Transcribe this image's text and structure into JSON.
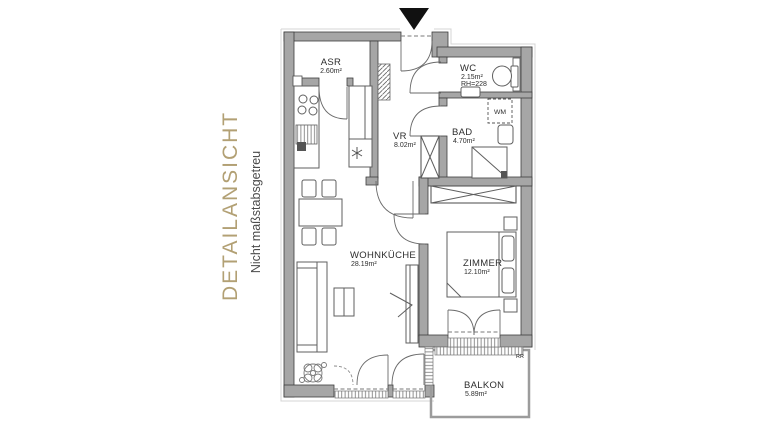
{
  "sidebar": {
    "title": "DETAILANSICHT",
    "subtitle": "Nicht maßstabsgetreu",
    "title_color": "#b2a074",
    "subtitle_color": "#4b4b4b"
  },
  "plan": {
    "rooms": [
      {
        "name": "ASR",
        "area": "2.60m²"
      },
      {
        "name": "WC",
        "area": "2.15m²",
        "note": "RH=228"
      },
      {
        "name": "BAD",
        "area": "4.70m²"
      },
      {
        "name": "VR",
        "area": "8.02m²"
      },
      {
        "name": "WOHNKÜCHE",
        "area": "28.19m²"
      },
      {
        "name": "ZIMMER",
        "area": "12.10m²"
      },
      {
        "name": "BALKON",
        "area": "5.89m²"
      }
    ],
    "labels": {
      "washing_machine": "WM",
      "rain_pipe": "RR"
    },
    "colors": {
      "wall_fill": "#a6a6a6",
      "wall_edge": "#3d3d3d",
      "furniture_line": "#5f5f5f",
      "entrance_marker": "#111111"
    }
  }
}
